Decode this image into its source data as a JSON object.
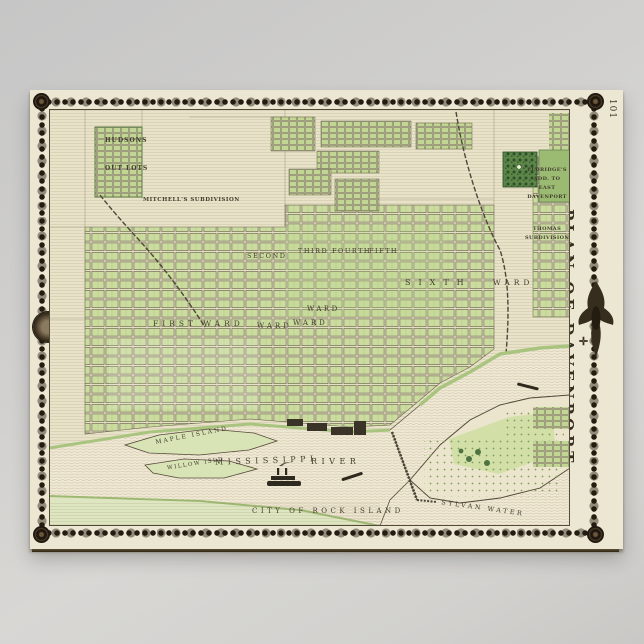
{
  "poster": {
    "page_number": "101",
    "ornament": "✛",
    "side_title_line1": "PLAN OF DAVENPORT,",
    "side_title_line2": "SCOTT COUNTY."
  },
  "map": {
    "labels": {
      "hudsons": "HUDSONS",
      "out_lots": "OUT LOTS",
      "mitchells": "MITCHELL'S SUBDIVISION",
      "first_ward": "FIRST WARD",
      "second": "SECOND",
      "third": "THIRD",
      "fourth": "FOURTH",
      "fifth": "FIFTH",
      "sixth": "SIXTH",
      "ward_a": "WARD",
      "ward_b": "WARD",
      "ward_c": "WARD",
      "ward_d": "WARD",
      "eldridges_l1": "ELDRIDGE'S",
      "eldridges_l2": "ADD. TO",
      "eldridges_l3": "EAST",
      "eldridges_l4": "DAVENPORT",
      "thomas_l1": "THOMAS",
      "thomas_l2": "SUBDIVISION",
      "maple_island": "MAPLE ISLAND",
      "willow_island": "WILLOW ISLD",
      "mississippi": "MISSISSIPPI",
      "river": "RIVER",
      "city_of_rock_island": "CITY OF ROCK ISLAND",
      "sylvan_water": "SYLVAN WATER"
    },
    "colors": {
      "paper": "#ece7d2",
      "map_base": "#e8e2c9",
      "block_green": "#cbdc9f",
      "dark_green": "#5c8648",
      "water": "#efe9d6",
      "border_ink": "#241c11",
      "background_gray": "#d2d1ce"
    }
  }
}
